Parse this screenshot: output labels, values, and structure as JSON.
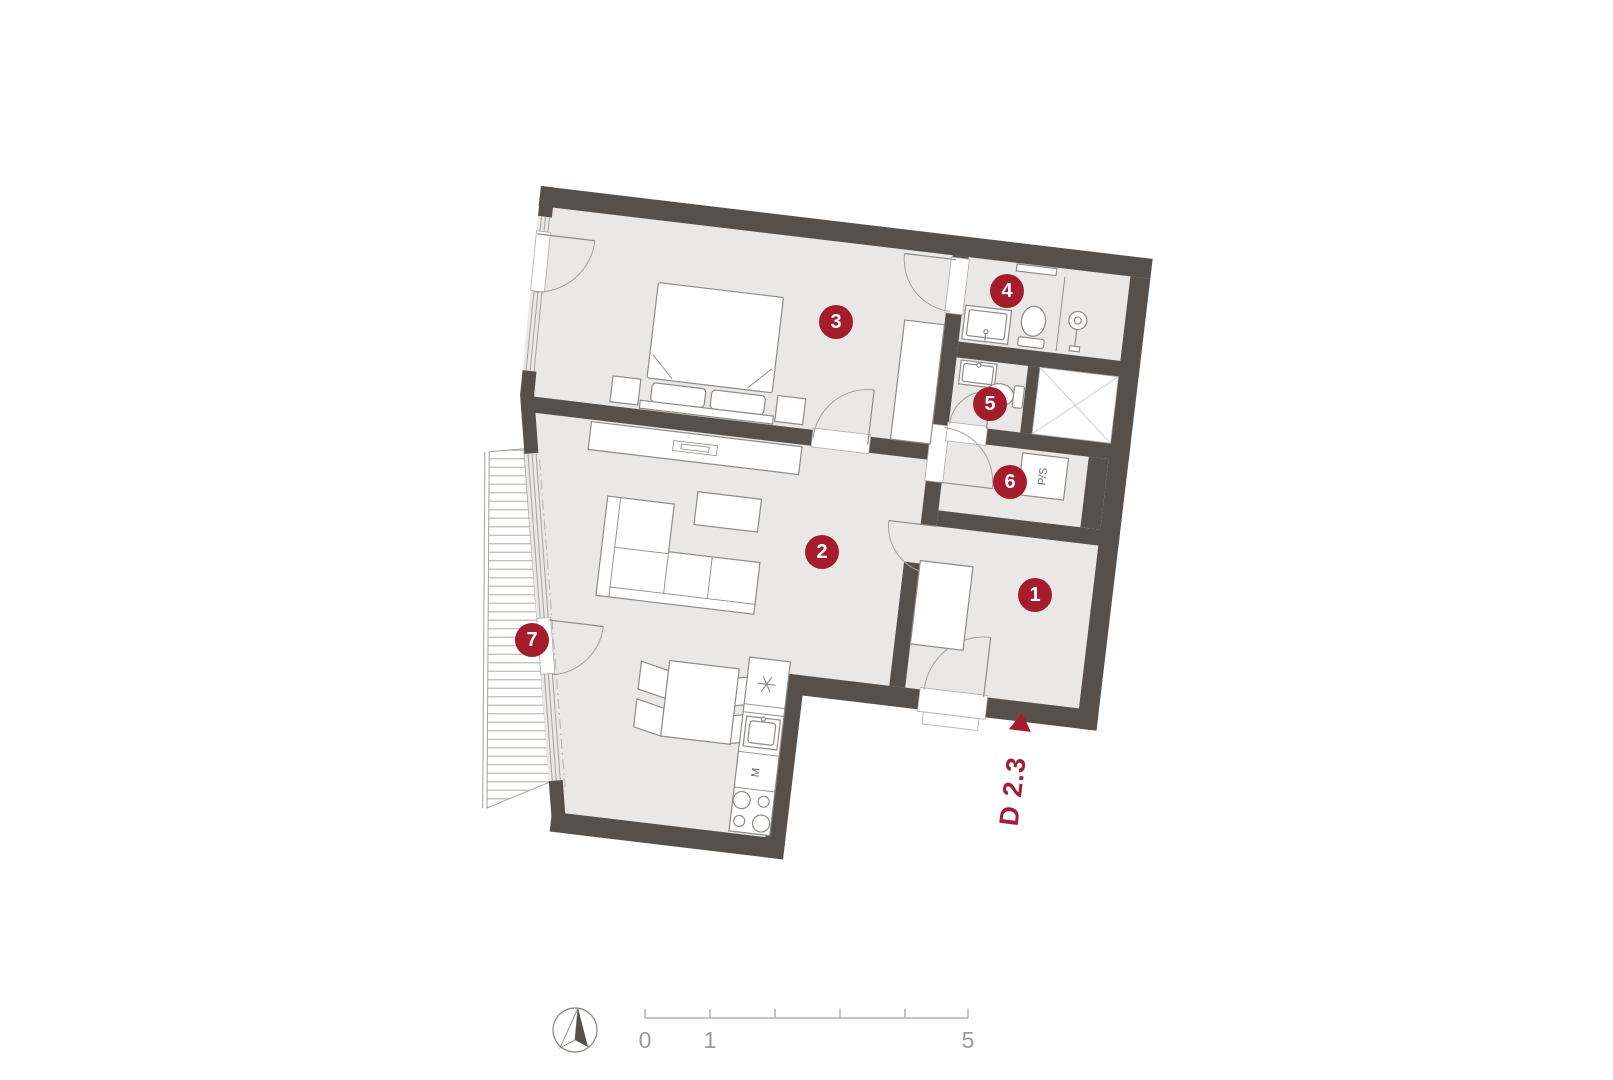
{
  "plan": {
    "unit_label": "D 2.3",
    "rooms": [
      {
        "number": "1"
      },
      {
        "number": "2"
      },
      {
        "number": "3"
      },
      {
        "number": "4"
      },
      {
        "number": "5"
      },
      {
        "number": "6"
      },
      {
        "number": "7"
      }
    ],
    "labels": {
      "washer_dryer": "P/S",
      "kitchen_appliance": "M"
    }
  },
  "scale_bar": {
    "tick_labels": [
      "0",
      "1",
      "5"
    ]
  },
  "colors": {
    "wall": "#57504A",
    "floor": "#E9E8E7",
    "accent_red": "#A51D2D",
    "line_gray": "#A5A19B"
  }
}
